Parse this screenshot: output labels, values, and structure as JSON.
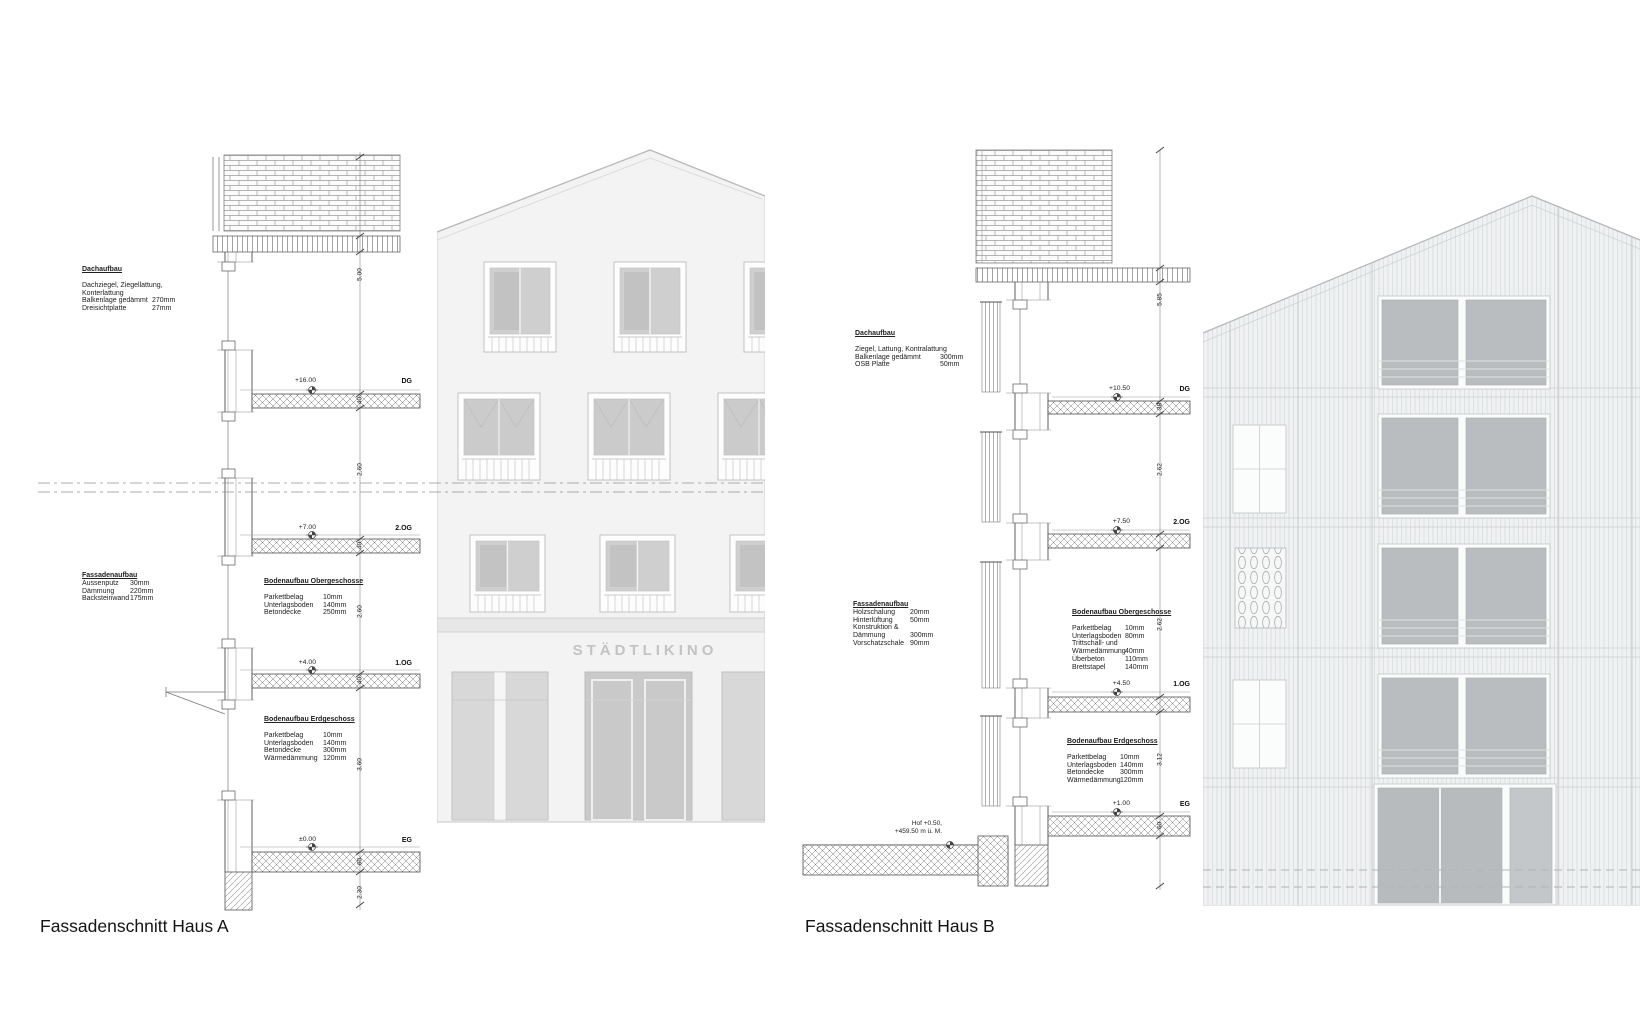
{
  "sheet": {
    "title_a": "Fassadenschnitt Haus A",
    "title_b": "Fassadenschnitt Haus B",
    "elevation_sign": "STÄDTLIKINO"
  },
  "haus_a": {
    "dachaufbau": {
      "title": "Dachaufbau",
      "rows": [
        {
          "l": "Dachziegel, Ziegellattung,",
          "v": ""
        },
        {
          "l": "Konterlattung",
          "v": ""
        },
        {
          "l": "Balkenlage gedämmt",
          "v": "270mm"
        },
        {
          "l": "Dreisichtplatte",
          "v": "27mm"
        }
      ]
    },
    "fassadenaufbau": {
      "title": "Fassadenaufbau",
      "rows": [
        {
          "l": "Aussenputz",
          "v": "30mm"
        },
        {
          "l": "Dämmung",
          "v": "220mm"
        },
        {
          "l": "Backsteinwand",
          "v": "175mm"
        }
      ]
    },
    "boden_og": {
      "title": "Bodenaufbau Obergeschosse",
      "rows": [
        {
          "l": "Parkettbelag",
          "v": "10mm"
        },
        {
          "l": "Unterlagsboden",
          "v": "140mm"
        },
        {
          "l": "Betondecke",
          "v": "250mm"
        }
      ]
    },
    "boden_eg": {
      "title": "Bodenaufbau Erdgeschoss",
      "rows": [
        {
          "l": "Parkettbelag",
          "v": "10mm"
        },
        {
          "l": "Unterlagsboden",
          "v": "140mm"
        },
        {
          "l": "Betondecke",
          "v": "300mm"
        },
        {
          "l": "Wärmedämmung",
          "v": "120mm"
        }
      ]
    },
    "levels": [
      {
        "value": "+16.00",
        "label": "DG"
      },
      {
        "value": "+7.00",
        "label": "2.OG"
      },
      {
        "value": "+4.00",
        "label": "1.OG"
      },
      {
        "value": "±0.00",
        "label": "EG"
      }
    ],
    "dims": [
      "5.00",
      "40",
      "2.60",
      "40",
      "2.60",
      "40",
      "3.60",
      "60",
      "2.30"
    ]
  },
  "haus_b": {
    "dachaufbau": {
      "title": "Dachaufbau",
      "rows": [
        {
          "l": "Ziegel, Lattung, Kontralattung",
          "v": ""
        },
        {
          "l": "Balkenlage gedämmt",
          "v": "300mm"
        },
        {
          "l": "OSB Platte",
          "v": "50mm"
        }
      ]
    },
    "fassadenaufbau": {
      "title": "Fassadenaufbau",
      "rows": [
        {
          "l": "Holzschalung",
          "v": "20mm"
        },
        {
          "l": "Hinterlüftung",
          "v": "50mm"
        },
        {
          "l": "Konstruktion &",
          "v": ""
        },
        {
          "l": "Dämmung",
          "v": "300mm"
        },
        {
          "l": "Vorschatzschale",
          "v": "90mm"
        }
      ]
    },
    "boden_og": {
      "title": "Bodenaufbau Obergeschosse",
      "rows": [
        {
          "l": "Parkettbelag",
          "v": "10mm"
        },
        {
          "l": "Unterlagsboden",
          "v": "80mm"
        },
        {
          "l": "Trittschall- und",
          "v": ""
        },
        {
          "l": "Wärmedämmung",
          "v": "40mm"
        },
        {
          "l": "Überbeton",
          "v": "110mm"
        },
        {
          "l": "Brettstapel",
          "v": "140mm"
        }
      ]
    },
    "boden_eg": {
      "title": "Bodenaufbau Erdgeschoss",
      "rows": [
        {
          "l": "Parkettbelag",
          "v": "10mm"
        },
        {
          "l": "Unterlagsboden",
          "v": "140mm"
        },
        {
          "l": "Betondecke",
          "v": "300mm"
        },
        {
          "l": "Wärmedämmung",
          "v": "120mm"
        }
      ]
    },
    "levels": [
      {
        "value": "+10.50",
        "label": "DG"
      },
      {
        "value": "+7.50",
        "label": "2.OG"
      },
      {
        "value": "+4.50",
        "label": "1.OG"
      },
      {
        "value": "+1.00",
        "label": "EG"
      }
    ],
    "ground": {
      "line1": "Hof +0.50,",
      "line2": "+459.50 m ü. M."
    },
    "dims": [
      "5.85",
      "38",
      "2.62",
      "2.62",
      "3.12",
      "60"
    ]
  }
}
